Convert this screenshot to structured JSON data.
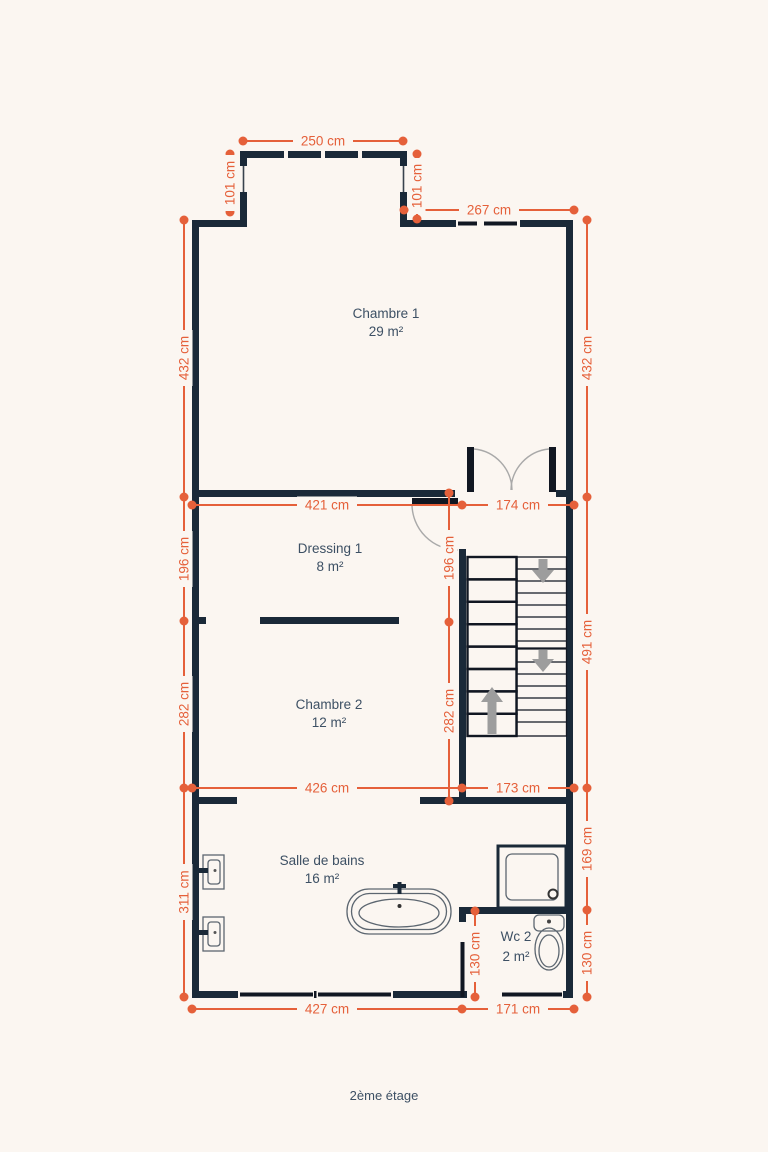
{
  "title_caption": "2ème étage",
  "colors": {
    "wall": "#1a2938",
    "accent": "#e5603a",
    "label_text": "#3d5064",
    "stair_arrow": "#9d9d9d",
    "background": "#fbf6f1"
  },
  "rooms": [
    {
      "name": "Chambre 1",
      "area": "29 m²"
    },
    {
      "name": "Dressing 1",
      "area": "8 m²"
    },
    {
      "name": "Chambre 2",
      "area": "12 m²"
    },
    {
      "name": "Salle de bains",
      "area": "16 m²"
    },
    {
      "name": "Wc 2",
      "area": "2 m²"
    }
  ],
  "dimensions": {
    "d250": "250 cm",
    "d101": "101 cm",
    "d267": "267 cm",
    "d432": "432 cm",
    "d421": "421 cm",
    "d174": "174 cm",
    "d196": "196 cm",
    "d491": "491 cm",
    "d282": "282 cm",
    "d426": "426 cm",
    "d173": "173 cm",
    "d311": "311 cm",
    "d169": "169 cm",
    "d130": "130 cm",
    "d427": "427 cm",
    "d171": "171 cm"
  }
}
